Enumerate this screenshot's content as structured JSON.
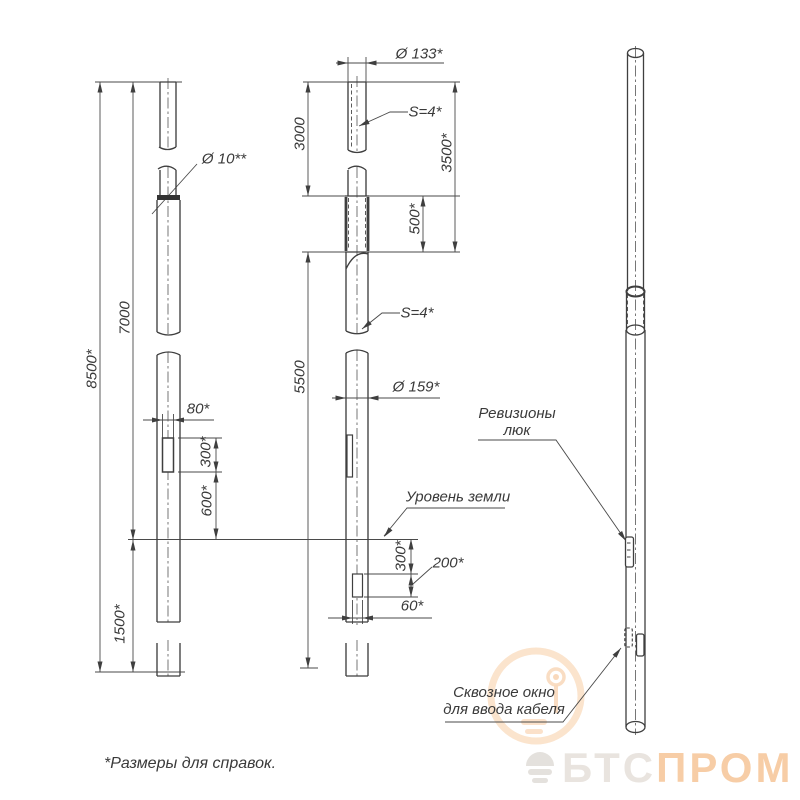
{
  "drawing": {
    "dimensions": {
      "total_height": "8500*",
      "above_ground": "7000",
      "embedment": "1500*",
      "upper_section": "3000",
      "lower_section": "5500",
      "upper_pipe_total": "3500*",
      "joint_overlap": "500*",
      "hatch_hole_width": "80*",
      "hatch_height": "300*",
      "hatch_elevation": "600*",
      "window_depth": "300*",
      "window_height": "200*",
      "window_width": "60*",
      "top_diameter": "Ø 133*",
      "bolt_hole_diameter": "Ø 10**",
      "bottom_diameter": "Ø 159*",
      "wall_thickness_upper": "S=4*",
      "wall_thickness_lower": "S=4*"
    },
    "labels": {
      "ground_level": "Уровень земли",
      "revision_hatch_line1": "Ревизионы",
      "revision_hatch_line2": "люк",
      "cable_window_line1": "Сквозное окно",
      "cable_window_line2": "для ввода кабеля",
      "footnote": "*Размеры для справок."
    }
  },
  "watermark": {
    "brand_part1": "БТС",
    "brand_part2": "ПРОМ",
    "accent_color": "#f7cda6",
    "muted_color": "#e9e4df"
  }
}
